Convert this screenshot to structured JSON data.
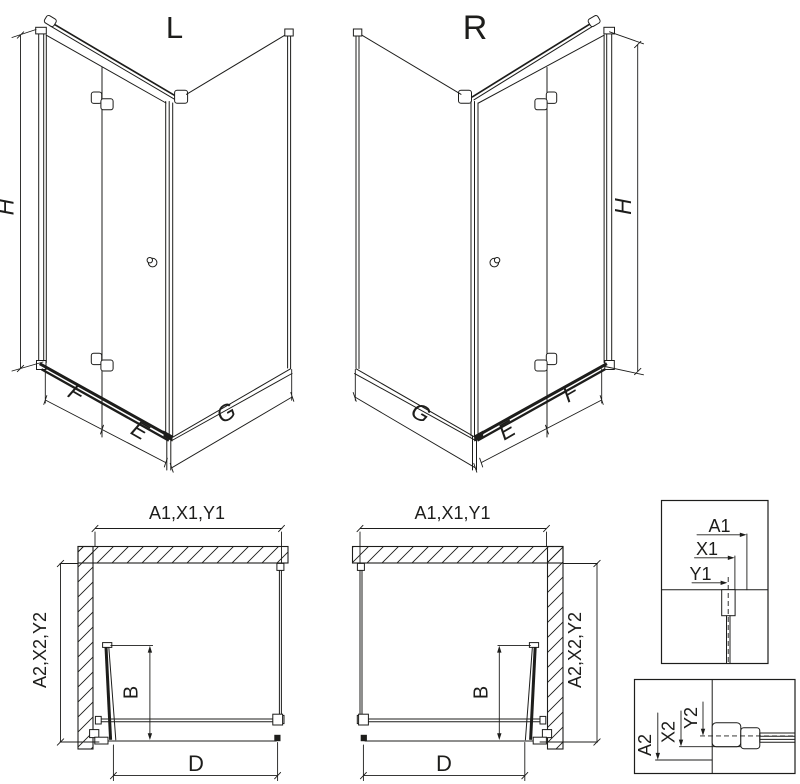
{
  "drawing": {
    "title_hint": "shower enclosure technical drawing, left (L) and right (R) bi-fold door variants",
    "ink_color": "#1d1d1b",
    "background_color": "#ffffff"
  },
  "iso_left": {
    "variant": "L",
    "dim_h": "H",
    "dim_f": "F",
    "dim_e": "E",
    "dim_g": "G"
  },
  "iso_right": {
    "variant": "R",
    "dim_h": "H",
    "dim_f": "F",
    "dim_e": "E",
    "dim_g": "G"
  },
  "plan_left": {
    "dim_top": "A1,X1,Y1",
    "dim_side": "A2,X2,Y2",
    "dim_b": "B",
    "dim_d": "D"
  },
  "plan_right": {
    "dim_top": "A1,X1,Y1",
    "dim_side": "A2,X2,Y2",
    "dim_b": "B",
    "dim_d": "D"
  },
  "detail_top": {
    "label_a": "A1",
    "label_x": "X1",
    "label_y": "Y1"
  },
  "detail_bottom": {
    "label_a": "A2",
    "label_x": "X2",
    "label_y": "Y2"
  }
}
